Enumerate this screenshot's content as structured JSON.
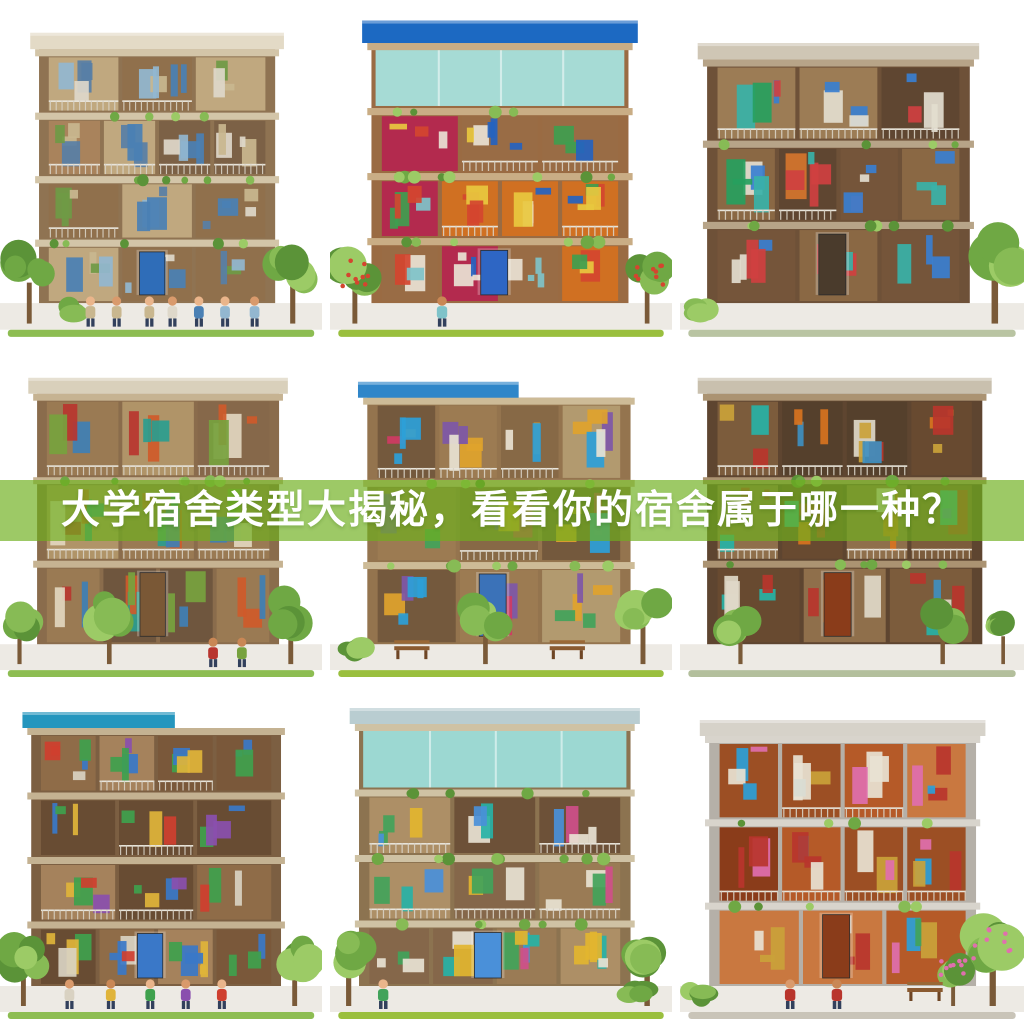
{
  "banner": {
    "text": "大学宿舍类型大揭秘，看看你的宿舍属于哪一种？",
    "overlay_color": "#6eaf1e",
    "overlay_opacity": 0.68,
    "text_color": "#ffffff"
  },
  "grid": {
    "rows": 3,
    "cols": 3
  },
  "palette": {
    "greens": [
      "#6fa844",
      "#87bb55",
      "#5b9338",
      "#9ccb66"
    ],
    "pavement": "#edeae4",
    "skin_tones": [
      "#eab58b",
      "#d99a6c",
      "#c98755"
    ]
  },
  "tiles": [
    {
      "name": "dorm-illustration-1",
      "desc": "beige three-storey dorm cross-section with students gathered outside",
      "seed": 11,
      "grass": "#8dbd52",
      "planters": true,
      "building": {
        "x": 48,
        "w": 226,
        "top": 48,
        "floors": 4,
        "roof": "#e3dac6",
        "slab": "#d3c5a8",
        "frame": "#8f7352",
        "interior": [
          "#a9835c",
          "#90704c",
          "#c0a87f",
          "#7c6146"
        ],
        "pops": [
          "#4a80b4",
          "#93b7d0",
          "#ded8ca",
          "#587fa6",
          "#6f9a45",
          "#c9b78f"
        ],
        "door": "#2f6db8"
      },
      "trees": [
        {
          "x": 30,
          "s": 1.0
        },
        {
          "x": 300,
          "s": 1.05
        }
      ],
      "shrubs": [
        {
          "x": 72
        }
      ],
      "people": {
        "count": 7,
        "from": 95,
        "to": 260
      }
    },
    {
      "name": "dorm-illustration-2",
      "desc": "colorful dorm with blue roof and teal glass top floor",
      "seed": 22,
      "grass": "#9abf3e",
      "planters": true,
      "flowers": "#d4452f",
      "building": {
        "x": 48,
        "w": 232,
        "top": 42,
        "floors": 4,
        "roof": "#1c69c2",
        "roof_h": 22,
        "glass": "#a6dbd5",
        "slab": "#c9ad85",
        "frame": "#9a6b43",
        "interior": [
          "#b32a4e",
          "#d07022",
          "#996c45",
          "#b4903f"
        ],
        "pops": [
          "#2563c0",
          "#e8c83f",
          "#3f9e4f",
          "#d4452f",
          "#e9e2d4",
          "#7fc3c9"
        ],
        "door": "#2e66c4"
      },
      "trees": [
        {
          "x": 24,
          "s": 0.95
        },
        {
          "x": 306,
          "s": 0.9
        }
      ],
      "shrubs": [],
      "people": {
        "count": 1,
        "from": 100,
        "to": 110
      }
    },
    {
      "name": "dorm-illustration-3",
      "desc": "brown stepped modern dorm with balconies and tall tree at right",
      "seed": 33,
      "grass": "#b9c4a2",
      "planters": true,
      "building": {
        "x": 34,
        "w": 236,
        "top": 58,
        "floors": 3,
        "roof": "#cfc6b5",
        "slab": "#b7a488",
        "frame": "#6e5138",
        "interior": [
          "#8a6844",
          "#75553a",
          "#9c7c55",
          "#5f4631"
        ],
        "pops": [
          "#27a05e",
          "#38b2a8",
          "#d5752c",
          "#3a7fd0",
          "#cf4040",
          "#e3ddcf"
        ],
        "door": "#4a3b2c"
      },
      "trees": [
        {
          "x": 302,
          "s": 1.25
        }
      ],
      "shrubs": [
        {
          "x": 18
        }
      ],
      "people": {
        "count": 0,
        "from": 0,
        "to": 0
      }
    },
    {
      "name": "dorm-illustration-4",
      "desc": "tan dorm with plant-filled balconies and shop-like ground floor",
      "seed": 44,
      "grass": "#8dbd52",
      "planters": true,
      "building": {
        "x": 46,
        "w": 232,
        "top": 44,
        "floors": 3,
        "roof": "#d9d0bb",
        "slab": "#c6b392",
        "frame": "#8a6c4c",
        "interior": [
          "#9a7a53",
          "#86684a",
          "#b09468",
          "#6f563e"
        ],
        "pops": [
          "#2a9d8f",
          "#cf5a2a",
          "#3f7fb5",
          "#77a23e",
          "#e2d6bf",
          "#b8352f"
        ],
        "door": "#7a5836"
      },
      "trees": [
        {
          "x": 20,
          "s": 0.85
        },
        {
          "x": 112,
          "s": 0.95
        },
        {
          "x": 298,
          "s": 1.0
        }
      ],
      "shrubs": [],
      "people": {
        "count": 2,
        "from": 222,
        "to": 244
      }
    },
    {
      "name": "dorm-illustration-5",
      "desc": "dorm with blue awning roof, benches and blue pool panel",
      "seed": 55,
      "grass": "#9abf3e",
      "planters": true,
      "building": {
        "x": 44,
        "w": 238,
        "top": 48,
        "floors": 3,
        "roof": "#2f86c9",
        "roof_style": "left",
        "slab": "#cdbb97",
        "frame": "#94744e",
        "interior": [
          "#9c7b52",
          "#876946",
          "#b29a6f",
          "#74593d"
        ],
        "pops": [
          "#2d9fd8",
          "#cf3b63",
          "#e0a32c",
          "#42a35a",
          "#e8e2d2",
          "#7e57a8"
        ],
        "door": "#3b72b8"
      },
      "trees": [
        {
          "x": 150,
          "s": 0.9
        },
        {
          "x": 302,
          "s": 0.95
        }
      ],
      "shrubs": [
        {
          "x": 24
        }
      ],
      "benches": [
        {
          "x": 62
        },
        {
          "x": 212
        }
      ],
      "people": {
        "count": 0,
        "from": 0,
        "to": 0
      }
    },
    {
      "name": "dorm-illustration-6",
      "desc": "dense dark-brown dorm with teal windows and warm lit room",
      "seed": 66,
      "grass": "#b3bf9c",
      "planters": true,
      "building": {
        "x": 34,
        "w": 248,
        "top": 44,
        "floors": 3,
        "roof": "#c9c0ae",
        "slab": "#ab9372",
        "frame": "#5e4530",
        "interior": [
          "#7c5c3c",
          "#684a30",
          "#8f6f4b",
          "#55402c"
        ],
        "pops": [
          "#27b2a6",
          "#d8731f",
          "#b9352c",
          "#3f8fc0",
          "#e0d8c8",
          "#caa23a"
        ],
        "door": "#8a3c1a"
      },
      "trees": [
        {
          "x": 58,
          "s": 0.8
        },
        {
          "x": 252,
          "s": 0.85
        },
        {
          "x": 310,
          "s": 0.7
        }
      ],
      "shrubs": [],
      "people": {
        "count": 0,
        "from": 0,
        "to": 0
      }
    },
    {
      "name": "dorm-illustration-7",
      "desc": "dorm with teal-blue roof, blue door column and lounge scene outside",
      "seed": 77,
      "grass": "#8dbd52",
      "planters": false,
      "building": {
        "x": 40,
        "w": 240,
        "top": 38,
        "floors": 4,
        "roof": "#2596be",
        "roof_style": "left",
        "slab": "#c4b292",
        "frame": "#7c5f42",
        "interior": [
          "#8f6c48",
          "#7a583a",
          "#a5825c",
          "#684c33"
        ],
        "pops": [
          "#cf3f2f",
          "#3fa14d",
          "#3a78c8",
          "#e0b43a",
          "#d9d2c2",
          "#8a4fae"
        ],
        "door": "#3a78c8"
      },
      "trees": [
        {
          "x": 24,
          "s": 1.0
        },
        {
          "x": 302,
          "s": 1.0
        }
      ],
      "shrubs": [],
      "people": {
        "count": 5,
        "from": 70,
        "to": 230
      }
    },
    {
      "name": "dorm-illustration-8",
      "desc": "green-terraced dorm with teal glass roof, blue frame and bed",
      "seed": 88,
      "grass": "#9abf3e",
      "planters": true,
      "building": {
        "x": 36,
        "w": 246,
        "top": 34,
        "floors": 4,
        "roof": "#b9cdd1",
        "glass": "#9cd8d2",
        "slab": "#cfc2a4",
        "frame": "#8c7350",
        "interior": [
          "#9a7b55",
          "#85674a",
          "#ad8f66",
          "#6d5138"
        ],
        "pops": [
          "#4a90d9",
          "#cf4f8a",
          "#42a35a",
          "#e2b52f",
          "#e8e2d2",
          "#27b2a6"
        ],
        "door": "#4a90d9"
      },
      "trees": [
        {
          "x": 18,
          "s": 1.0
        },
        {
          "x": 306,
          "s": 1.05
        }
      ],
      "shrubs": [
        {
          "x": 296
        }
      ],
      "people": {
        "count": 1,
        "from": 48,
        "to": 58
      }
    },
    {
      "name": "dorm-illustration-9",
      "desc": "white-framed dorm with orange wood rooms, pink blossoms and two residents",
      "seed": 99,
      "grass": "#c9c4b8",
      "planters": true,
      "flowers": "#e06fae",
      "building": {
        "x": 36,
        "w": 240,
        "top": 46,
        "floors": 3,
        "roof": "#d6d2c9",
        "slab": "#d8d4cc",
        "frame": "#b5b0a8",
        "interior": [
          "#b55a28",
          "#8a3c1a",
          "#c97840",
          "#9c4f24"
        ],
        "pops": [
          "#e06fae",
          "#42a35a",
          "#2d9fd8",
          "#caa23a",
          "#e8e2d2",
          "#b9352c"
        ],
        "door": "#8a3c1a"
      },
      "trees": [
        {
          "x": 300,
          "s": 1.2
        },
        {
          "x": 262,
          "s": 0.75
        }
      ],
      "shrubs": [
        {
          "x": 16
        }
      ],
      "benches": [
        {
          "x": 218
        }
      ],
      "people": {
        "count": 2,
        "from": 104,
        "to": 152
      }
    }
  ]
}
